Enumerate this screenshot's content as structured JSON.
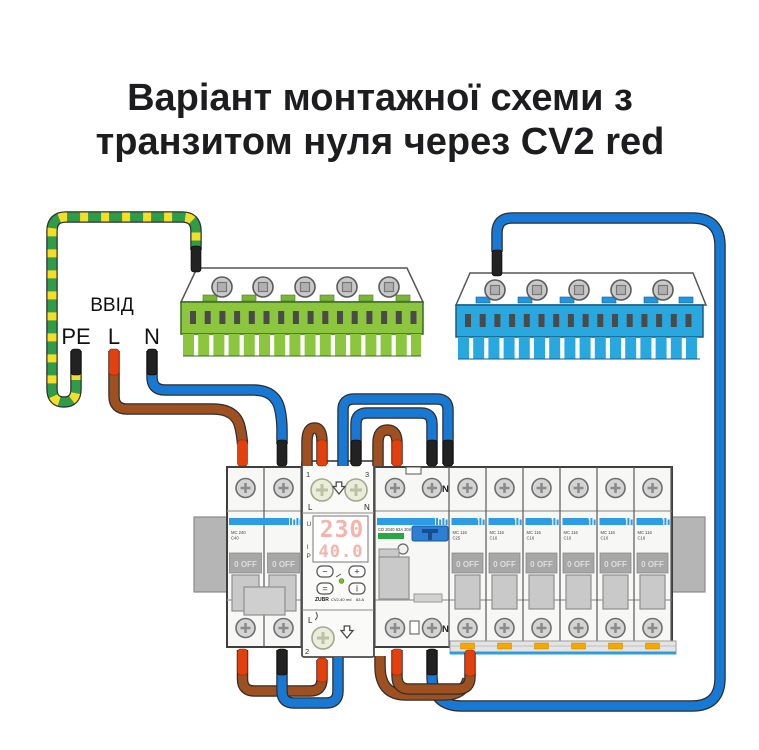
{
  "title": {
    "line1": "Варіант монтажної схеми з",
    "line2": "транзитом нуля через CV2 red"
  },
  "input": {
    "label": "ВВІД",
    "pe": "PE",
    "live": "L",
    "neutral": "N"
  },
  "cv2": {
    "terminal_1": "1",
    "terminal_3": "3",
    "terminal_2": "2",
    "l_top": "L",
    "n_top": "N",
    "l_bottom": "L",
    "u": "U",
    "i": "I",
    "p": "P",
    "voltage": "230",
    "current": "40.0",
    "btn_minus": "−",
    "btn_plus": "+",
    "btn_set": "=",
    "btn_power": "i",
    "brand": "ZUBR",
    "model": "CV2-40 red",
    "rating": "63 A"
  },
  "main_breaker": {
    "line1": "MC 240",
    "line2": "C40"
  },
  "rcd": {
    "label": "CD 2040 63A 30mA",
    "n_top": "N",
    "n_bottom": "N"
  },
  "mcbs": [
    {
      "line1": "MC 116",
      "line2": "C25"
    },
    {
      "line1": "MC 116",
      "line2": "C16"
    },
    {
      "line1": "MC 116",
      "line2": "C16"
    },
    {
      "line1": "MC 116",
      "line2": "C16"
    },
    {
      "line1": "MC 116",
      "line2": "C16"
    },
    {
      "line1": "MC 116",
      "line2": "C16"
    }
  ],
  "panel": {
    "off_label": "0 OFF"
  },
  "colors": {
    "wire_brown": "#9E5020",
    "wire_blue": "#1879D4",
    "pe_green": "#2E9C48",
    "pe_yellow": "#F4DF26",
    "busbar_green": "#8CC63E",
    "busbar_blue": "#29A8E0",
    "ferrule_red": "#E2410E",
    "ferrule_black": "#222222",
    "display_red": "#F4B4AC",
    "led_green": "#7CB82F",
    "stripe_blue": "#2D9CE5",
    "clip_orange": "#F5A800"
  }
}
